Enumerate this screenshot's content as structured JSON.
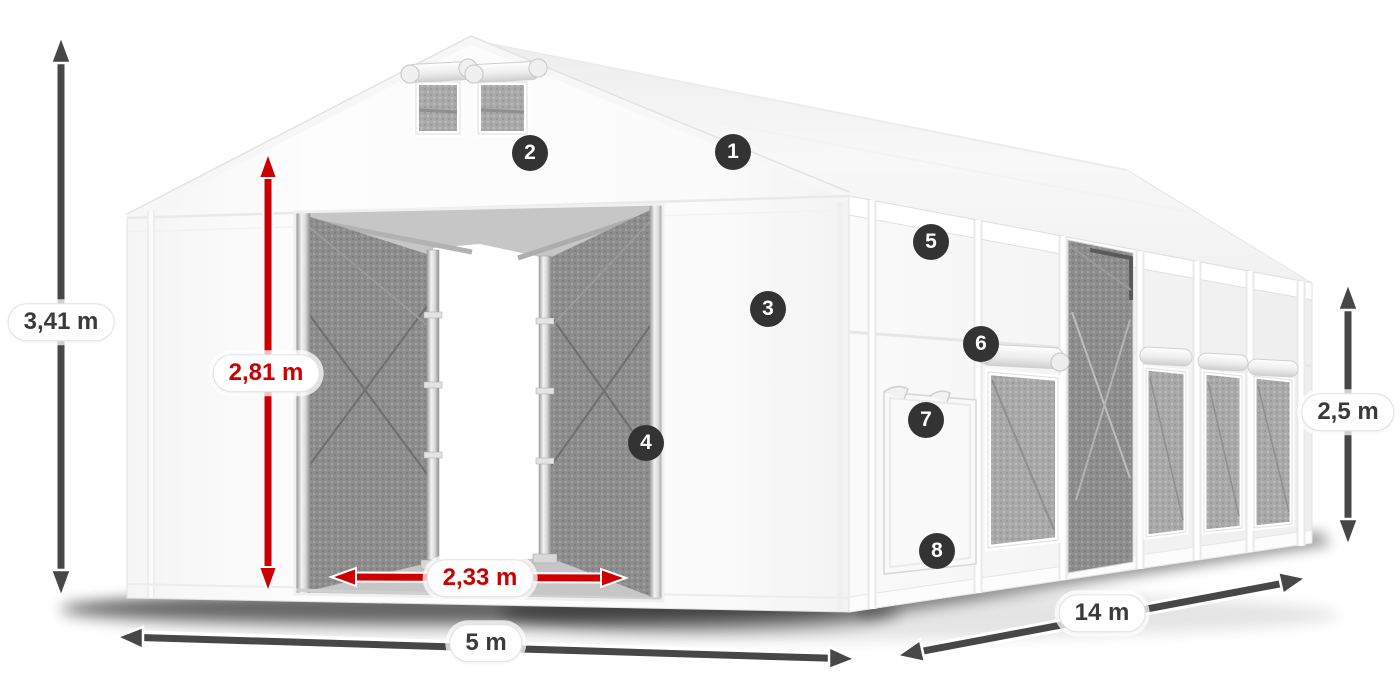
{
  "title": "Tent dimension diagram",
  "dimensions": {
    "total_height": {
      "value": "3,41 m",
      "color": "#3a3a3a"
    },
    "entrance_height": {
      "value": "2,81 m",
      "color": "#cc0000"
    },
    "entrance_width": {
      "value": "2,33 m",
      "color": "#cc0000"
    },
    "front_width": {
      "value": "5 m",
      "color": "#3a3a3a"
    },
    "side_length": {
      "value": "14 m",
      "color": "#3a3a3a"
    },
    "side_height": {
      "value": "2,5 m",
      "color": "#3a3a3a"
    }
  },
  "markers": [
    {
      "number": "1"
    },
    {
      "number": "2"
    },
    {
      "number": "3"
    },
    {
      "number": "4"
    },
    {
      "number": "5"
    },
    {
      "number": "6"
    },
    {
      "number": "7"
    },
    {
      "number": "8"
    }
  ],
  "colors": {
    "dimension_dark": "#474747",
    "dimension_red": "#cc0000",
    "marker_background": "#333333",
    "marker_text": "#ffffff",
    "background": "#ffffff"
  }
}
